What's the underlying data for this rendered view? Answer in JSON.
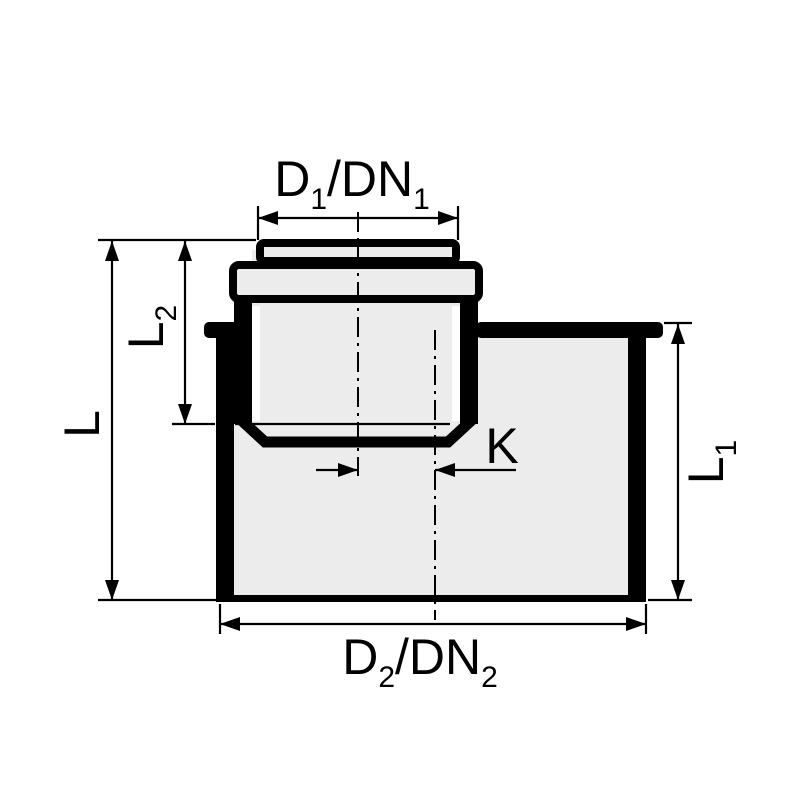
{
  "diagram": {
    "type": "technical-dimension-drawing",
    "colors": {
      "outline": "#000000",
      "fill_light": "#ececec",
      "inner_white": "#ffffff",
      "background": "#ffffff",
      "label": "#000000"
    },
    "labels": {
      "top_diameter": {
        "base1": "D",
        "sub1": "1",
        "base2": "/DN",
        "sub2": "1"
      },
      "bottom_diameter": {
        "base1": "D",
        "sub1": "2",
        "base2": "/DN",
        "sub2": "2"
      },
      "overall_length": {
        "base": "L"
      },
      "branch_length": {
        "base": "L",
        "sub": "2"
      },
      "body_length": {
        "base": "L",
        "sub": "1"
      },
      "offset": {
        "base": "K"
      }
    }
  }
}
